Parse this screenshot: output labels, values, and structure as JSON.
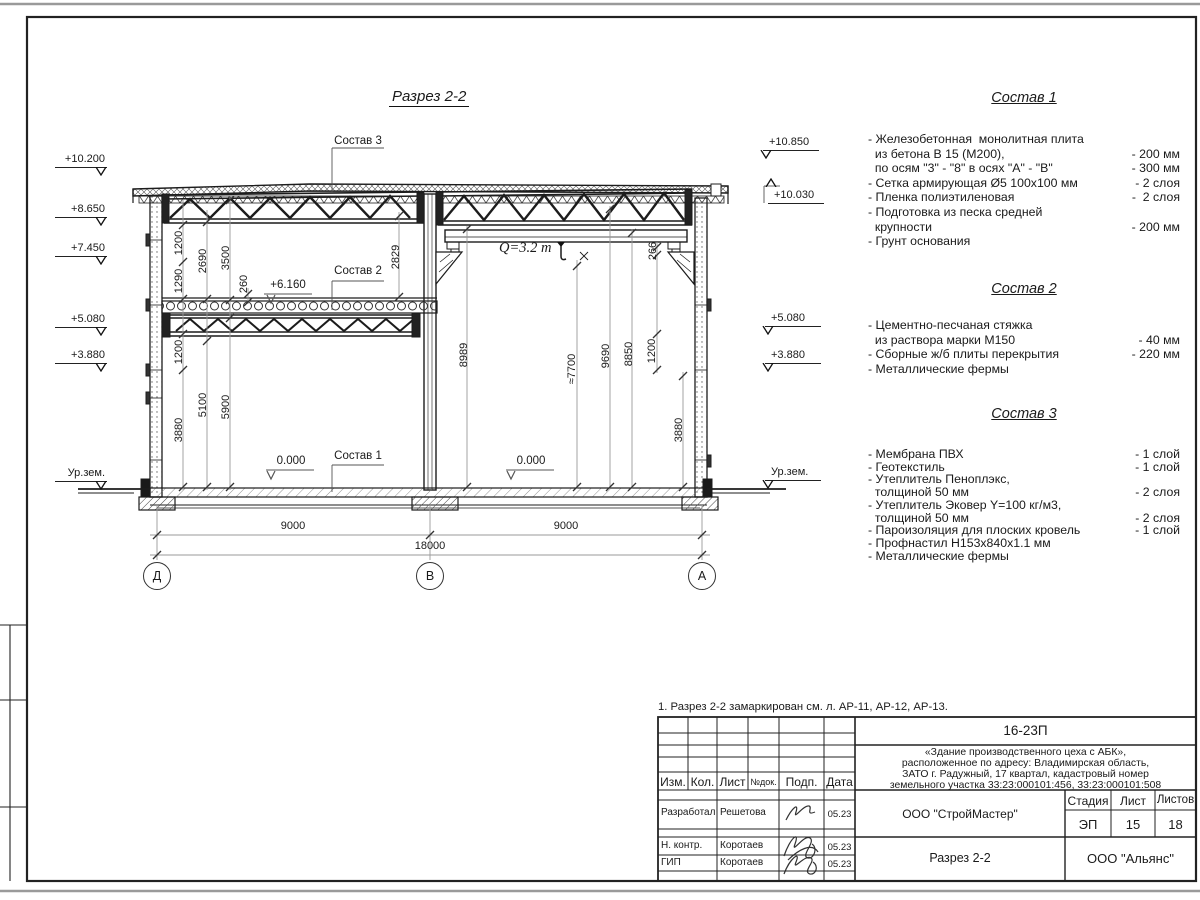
{
  "sheet": {
    "note": "1. Разрез 2-2 замаркирован см. л. АР-11, АР-12, АР-13."
  },
  "drawing": {
    "title": "Разрез 2-2",
    "crane_label": "Q=3.2 т",
    "comp_labels": [
      {
        "text": "Состав 3",
        "x": 358,
        "y": 141
      },
      {
        "text": "Состав 2",
        "x": 358,
        "y": 271
      },
      {
        "text": "Состав 1",
        "x": 358,
        "y": 456
      }
    ],
    "callouts": [
      {
        "text": "0.000",
        "x": 291,
        "y": 461
      },
      {
        "text": "0.000",
        "x": 531,
        "y": 461
      },
      {
        "text": "+6.160",
        "x": 288,
        "y": 285
      }
    ],
    "elevations": [
      {
        "text": "+10.200",
        "x": 55,
        "y": 153,
        "side": "l"
      },
      {
        "text": "+8.650",
        "x": 55,
        "y": 203,
        "side": "l"
      },
      {
        "text": "+7.450",
        "x": 55,
        "y": 242,
        "side": "l"
      },
      {
        "text": "+5.080",
        "x": 55,
        "y": 313,
        "side": "l"
      },
      {
        "text": "+3.880",
        "x": 55,
        "y": 349,
        "side": "l"
      },
      {
        "text": "Ур.зем.",
        "x": 55,
        "y": 467,
        "side": "l"
      },
      {
        "text": "+10.850",
        "x": 763,
        "y": 136,
        "side": "r"
      },
      {
        "text": "+10.030",
        "x": 768,
        "y": 189,
        "side": "r",
        "dir": "up"
      },
      {
        "text": "+5.080",
        "x": 765,
        "y": 312,
        "side": "r"
      },
      {
        "text": "+3.880",
        "x": 765,
        "y": 349,
        "side": "r"
      },
      {
        "text": "Ур.зем.",
        "x": 765,
        "y": 466,
        "side": "r"
      }
    ],
    "dimensions": [
      {
        "text": "1200",
        "x": 179,
        "y": 243,
        "rot": 1
      },
      {
        "text": "1290",
        "x": 179,
        "y": 281,
        "rot": 1
      },
      {
        "text": "2690",
        "x": 203,
        "y": 261,
        "rot": 1
      },
      {
        "text": "3500",
        "x": 226,
        "y": 258,
        "rot": 1
      },
      {
        "text": "260",
        "x": 244,
        "y": 284,
        "rot": 1
      },
      {
        "text": "2829",
        "x": 396,
        "y": 257,
        "rot": 1
      },
      {
        "text": "1200",
        "x": 179,
        "y": 352,
        "rot": 1
      },
      {
        "text": "3880",
        "x": 179,
        "y": 430,
        "rot": 1
      },
      {
        "text": "5100",
        "x": 203,
        "y": 405,
        "rot": 1
      },
      {
        "text": "5900",
        "x": 226,
        "y": 407,
        "rot": 1
      },
      {
        "text": "266",
        "x": 653,
        "y": 251,
        "rot": 1
      },
      {
        "text": "8989",
        "x": 464,
        "y": 355,
        "rot": 1
      },
      {
        "text": "≈7700",
        "x": 572,
        "y": 369,
        "rot": 1
      },
      {
        "text": "9690",
        "x": 606,
        "y": 356,
        "rot": 1
      },
      {
        "text": "8850",
        "x": 629,
        "y": 354,
        "rot": 1
      },
      {
        "text": "1200",
        "x": 652,
        "y": 351,
        "rot": 1
      },
      {
        "text": "3880",
        "x": 679,
        "y": 430,
        "rot": 1
      },
      {
        "text": "9000",
        "x": 293,
        "y": 526
      },
      {
        "text": "9000",
        "x": 566,
        "y": 526
      },
      {
        "text": "18000",
        "x": 430,
        "y": 546
      }
    ],
    "axes": [
      {
        "label": "Д",
        "x": 157
      },
      {
        "label": "В",
        "x": 430
      },
      {
        "label": "А",
        "x": 702
      }
    ]
  },
  "compositions": [
    {
      "title": "Состав 1",
      "rows": [
        {
          "t": "- Железобетонная  монолитная плита",
          "v": ""
        },
        {
          "t": "  из бетона В 15 (М200),",
          "v": "- 200 мм"
        },
        {
          "t": "  по осям \"3\" - \"8\" в осях \"А\" - \"В\"",
          "v": "- 300 мм"
        },
        {
          "t": "- Сетка армирующая Ø5 100х100 мм",
          "v": "- 2 слоя"
        },
        {
          "t": "- Пленка полиэтиленовая",
          "v": "-  2 слоя"
        },
        {
          "t": "- Подготовка из песка средней",
          "v": ""
        },
        {
          "t": "  крупности",
          "v": "- 200 мм"
        },
        {
          "t": "- Грунт основания",
          "v": ""
        }
      ]
    },
    {
      "title": "Состав 2",
      "rows": [
        {
          "t": "- Цементно-песчаная стяжка",
          "v": ""
        },
        {
          "t": "  из раствора марки М150",
          "v": "- 40 мм"
        },
        {
          "t": "- Сборные ж/б плиты перекрытия",
          "v": "- 220 мм"
        },
        {
          "t": "- Металлические фермы",
          "v": ""
        }
      ]
    },
    {
      "title": "Состав 3",
      "rows": [
        {
          "t": "- Мембрана ПВХ",
          "v": "- 1 слой"
        },
        {
          "t": "- Геотекстиль",
          "v": "- 1 слой"
        },
        {
          "t": "- Утеплитель Пеноплэкс,",
          "v": ""
        },
        {
          "t": "  толщиной 50 мм",
          "v": "- 2 слоя"
        },
        {
          "t": "- Утеплитель Эковер Y=100 кг/м3,",
          "v": ""
        },
        {
          "t": "  толщиной 50 мм",
          "v": "- 2 слоя"
        },
        {
          "t": "- Пароизоляция для плоских кровель",
          "v": "- 1 слой"
        },
        {
          "t": "- Профнастил Н153х840х1.1 мм",
          "v": ""
        },
        {
          "t": "- Металлические фермы",
          "v": ""
        }
      ]
    }
  ],
  "title_block": {
    "doc_number": "16-23П",
    "project_description": [
      "«Здание производственного цеха с АБК»,",
      "расположенное по адресу: Владимирская область,",
      "ЗАТО г. Радужный, 17 квартал, кадастровый номер",
      "земельного участка 33:23:000101:456, 33:23:000101:508"
    ],
    "columns": [
      "Изм.",
      "Кол.",
      "Лист",
      "№док.",
      "Подп.",
      "Дата"
    ],
    "rows": [
      {
        "role": "Разработал",
        "name": "Решетова",
        "date": "05.23"
      },
      {
        "role": "Н. контр.",
        "name": "Коротаев",
        "date": "05.23"
      },
      {
        "role": "ГИП",
        "name": "Коротаев",
        "date": "05.23"
      }
    ],
    "organization": "ООО \"СтройМастер\"",
    "stage_label": "Стадия",
    "sheet_label": "Лист",
    "sheets_label": "Листов",
    "stage": "ЭП",
    "sheet_no": "15",
    "sheets_total": "18",
    "section_name": "Разрез 2-2",
    "company": "ООО \"Альянс\""
  }
}
